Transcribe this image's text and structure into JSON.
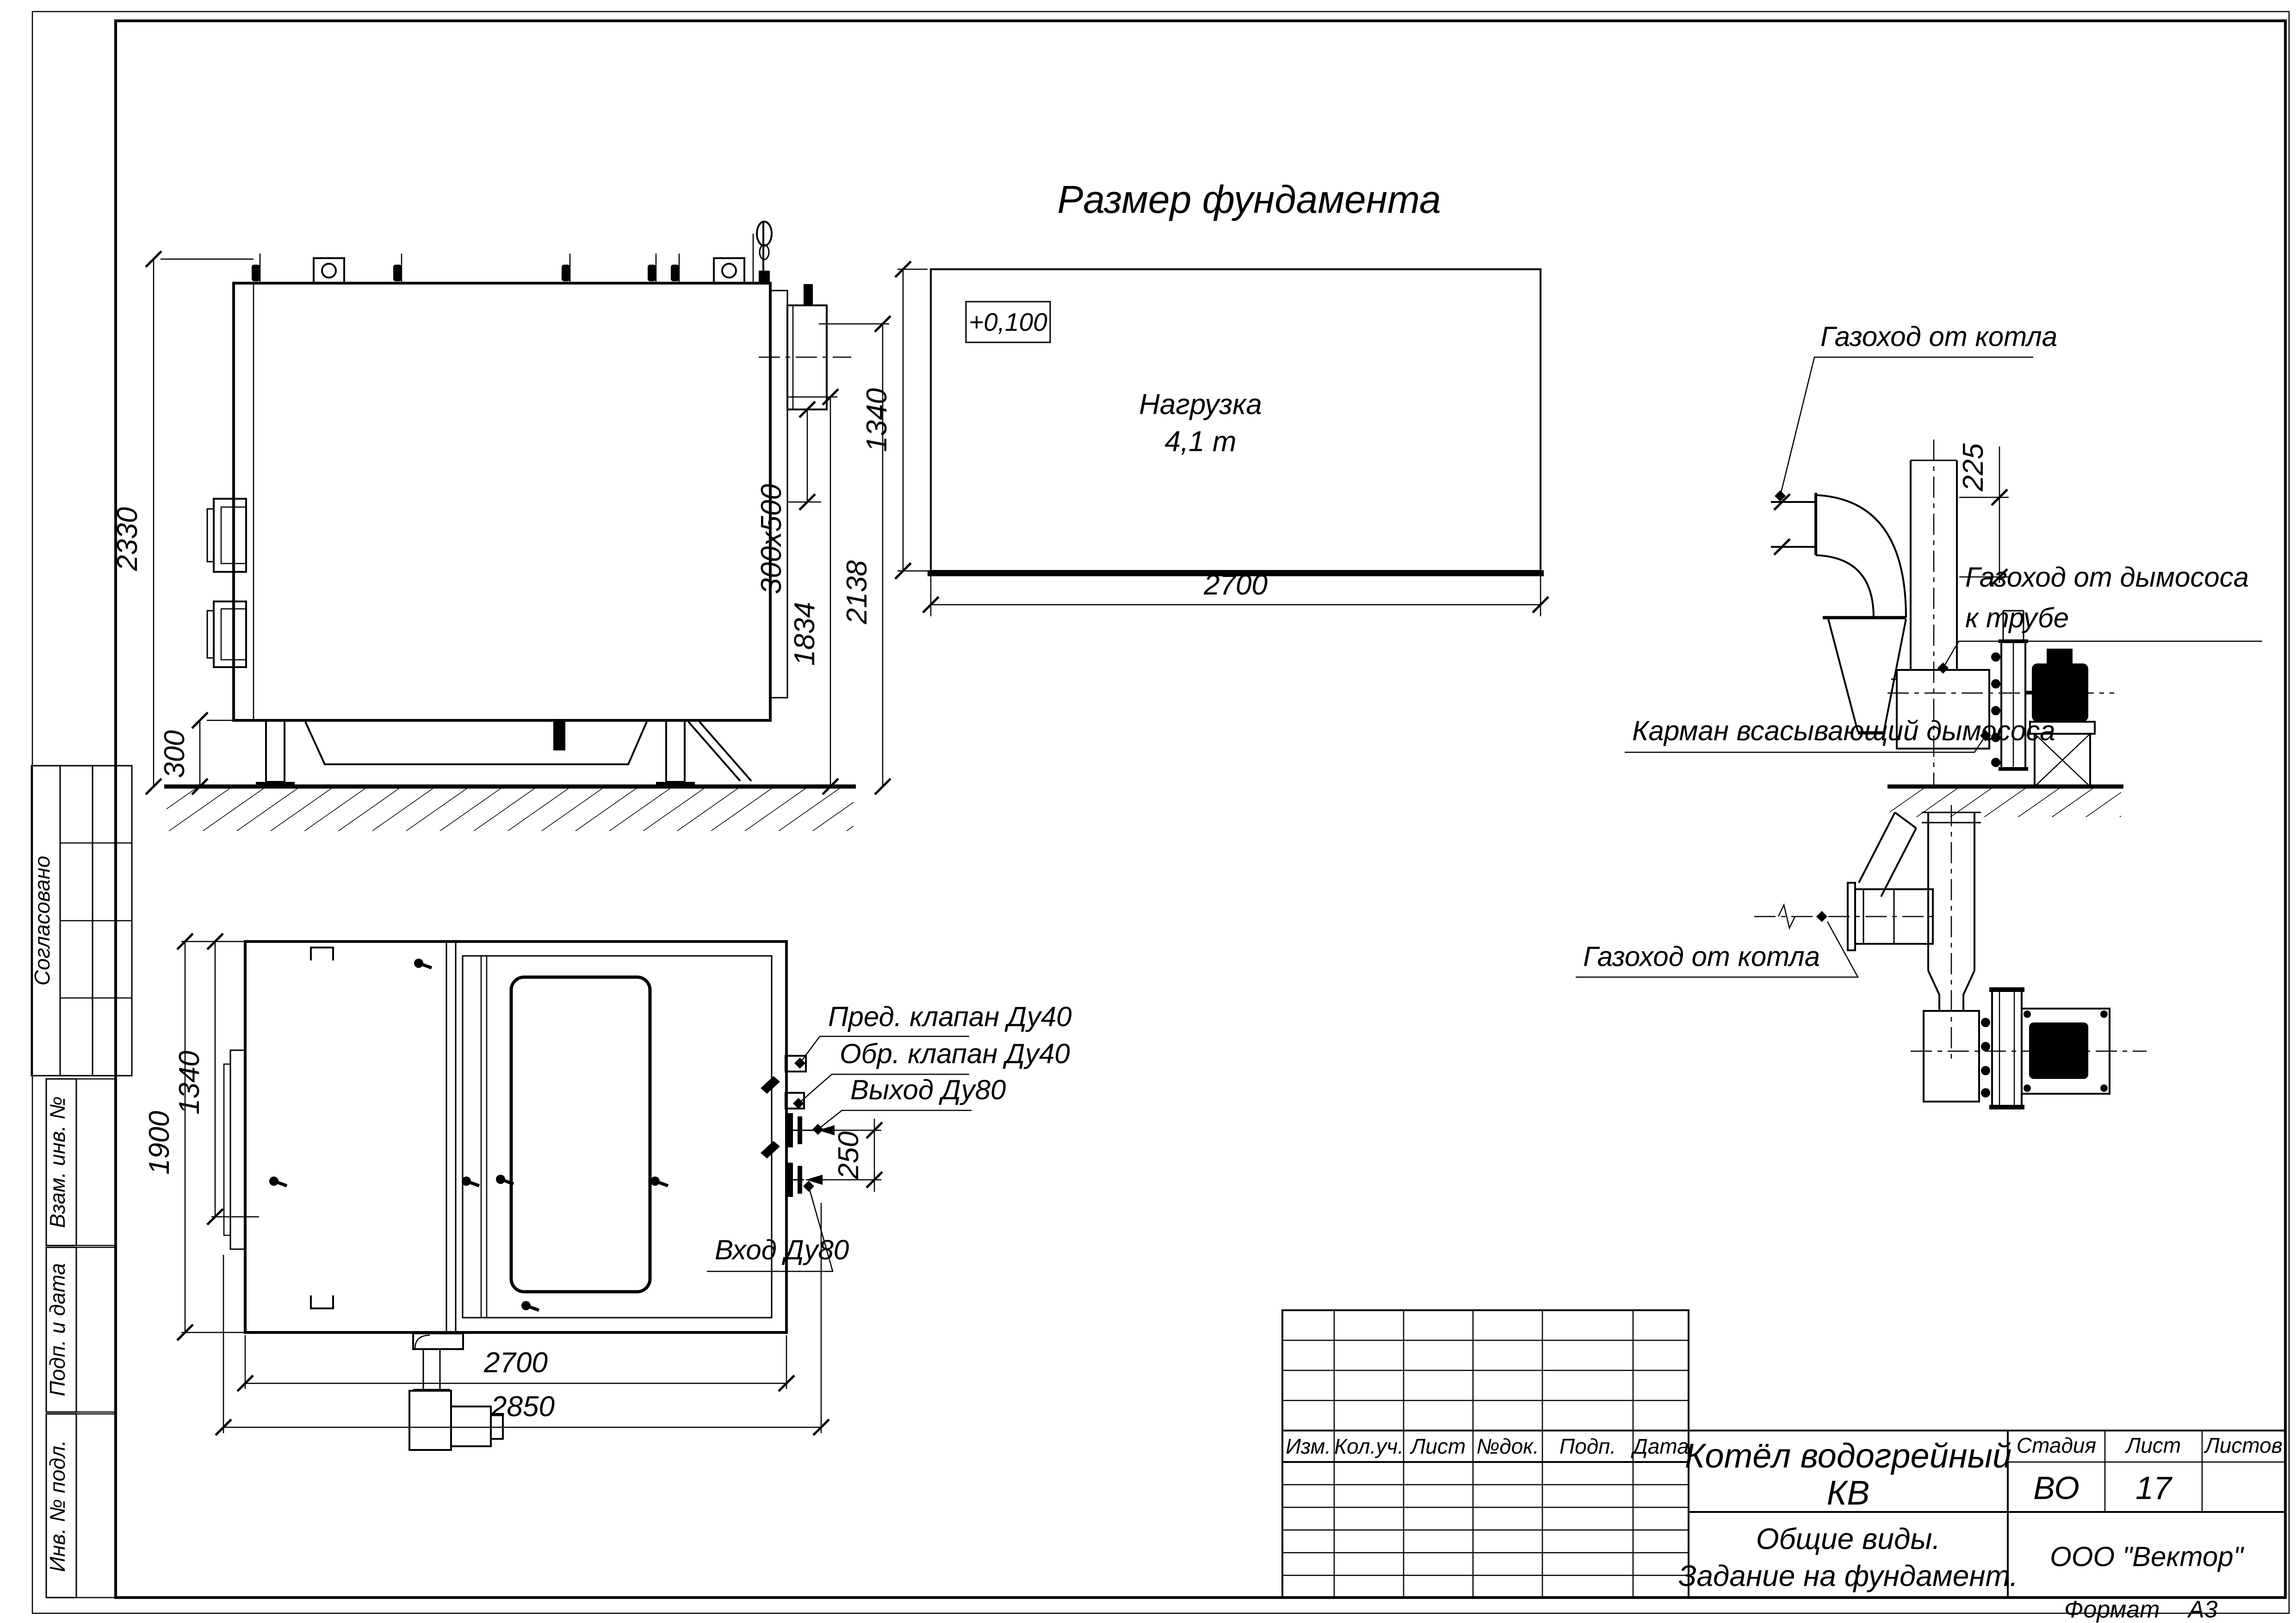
{
  "drawing": {
    "title": "Размер фундамента",
    "foundation": {
      "elevation": "+0,100",
      "load1": "Нагрузка",
      "load2": "4,1 т",
      "dim_width": "2700",
      "dim_depth": "1340"
    },
    "side_view": {
      "dim_total_height": "2330",
      "dim_foundation_height": "300",
      "dim_duct_size": "300х500",
      "dim_outlet_to_ground": "1834",
      "dim_top_to_ground": "2138"
    },
    "plan_view": {
      "dim_width_total": "1900",
      "dim_width_inner": "1340",
      "dim_length": "2700",
      "dim_frame_length": "2850",
      "dim_pipe_gap": "250",
      "label_safety_valve": "Пред. клапан Ду40",
      "label_check_valve": "Обр. клапан Ду40",
      "label_outlet": "Выход Ду80",
      "label_inlet": "Вход Ду80"
    },
    "duct_side": {
      "label_from_boiler": "Газоход от котла",
      "dim_height": "225",
      "label_to_stack_1": "Газоход от дымососа",
      "label_to_stack_2": "к трубе",
      "label_pocket": "Карман всасывающий дымососа"
    },
    "duct_plan": {
      "label_from_boiler": "Газоход от котла"
    }
  },
  "margin_stamps": {
    "agreed": "Согласовано",
    "alt_inv": "Взам. инв. №",
    "sign_date": "Подп. и дата",
    "inv_orig": "Инв. № подл."
  },
  "title_block": {
    "rev_cols": [
      "Изм.",
      "Кол.уч.",
      "Лист",
      "№док.",
      "Подп.",
      "Дата"
    ],
    "doc_title_1": "Котёл водогрейный",
    "doc_title_2": "КВ",
    "stage_header": "Стадия",
    "sheet_header": "Лист",
    "sheets_header": "Листов",
    "stage_value": "ВО",
    "sheet_value": "17",
    "subtitle_1": "Общие виды.",
    "subtitle_2": "Задание на фундамент.",
    "company": "ООО \"Вектор\"",
    "format_label": "Формат",
    "format_value": "А3"
  }
}
